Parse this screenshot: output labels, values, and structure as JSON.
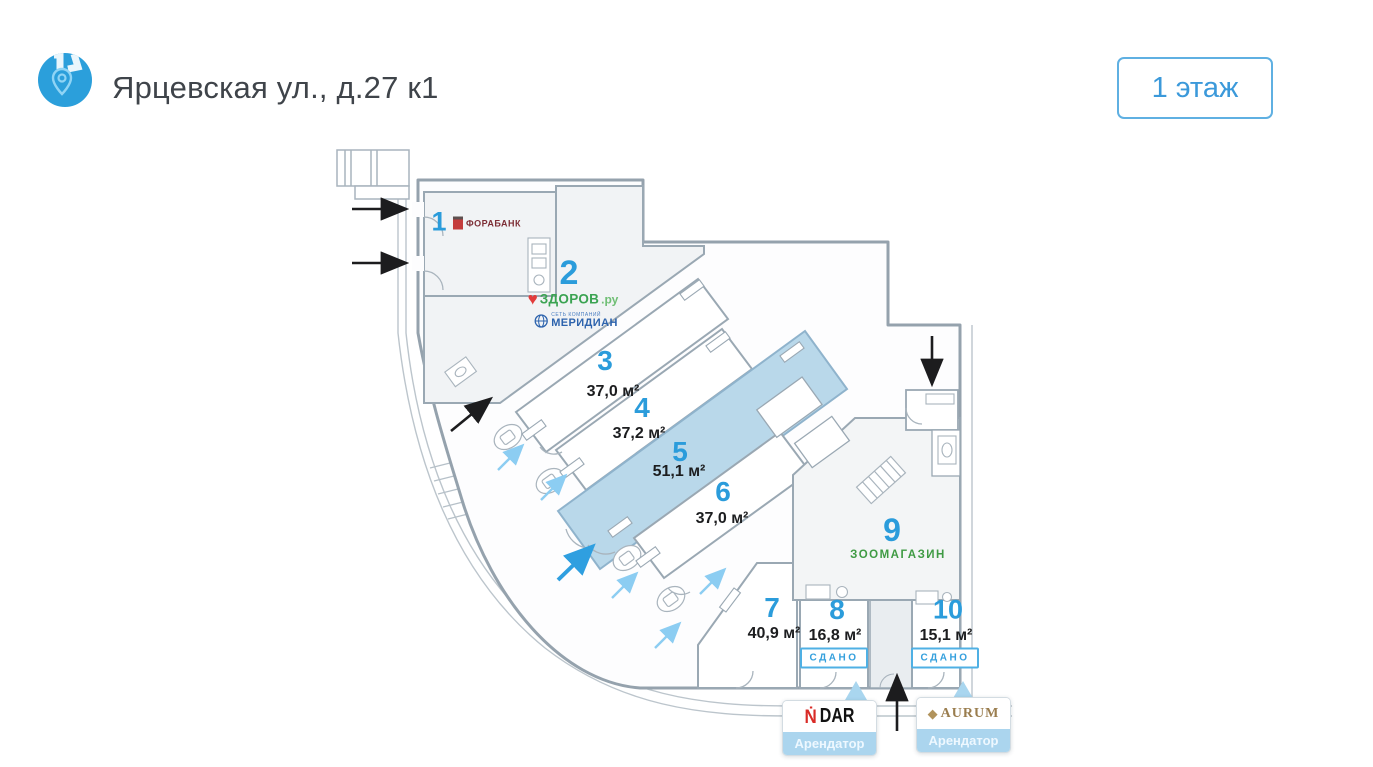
{
  "header": {
    "title": "Ярцевская ул., д.27 к1",
    "floor_button_label": "1 этаж"
  },
  "units": [
    {
      "number": "1",
      "tenant": "ФОРАБАНК"
    },
    {
      "number": "2",
      "tenant_logos": {
        "zdorov_main": "ЗДОРОВ",
        "zdorov_suffix": ".ру",
        "meridian_small": "СЕТЬ КОМПАНИЙ",
        "meridian": "МЕРИДИАН"
      }
    },
    {
      "number": "3",
      "area": "37,0 м²"
    },
    {
      "number": "4",
      "area": "37,2 м²"
    },
    {
      "number": "5",
      "area": "51,1 м²",
      "highlighted": true
    },
    {
      "number": "6",
      "area": "37,0 м²"
    },
    {
      "number": "7",
      "area": "40,9 м²"
    },
    {
      "number": "8",
      "area": "16,8 м²",
      "status": "СДАНО"
    },
    {
      "number": "9",
      "tenant": "ЗООМАГАЗИН"
    },
    {
      "number": "10",
      "area": "15,1 м²",
      "status": "СДАНО"
    }
  ],
  "callouts": [
    {
      "brand_mark": "Ṅ",
      "brand": "DAR",
      "label": "Арендатор"
    },
    {
      "brand_mark": "◆",
      "brand": "AURUM",
      "label": "Арендатор"
    }
  ],
  "colors": {
    "accent_blue": "#2b9cdb",
    "highlight_fill": "#b9d8ea",
    "status_blue": "#35a0dd",
    "zoo_green": "#3f9b44",
    "zdorov_green": "#3ba352",
    "meridian_blue": "#2d63ad",
    "forabank_red": "#c43c3c",
    "dar_red": "#d92b27",
    "aurum_gold": "#9a7d4e",
    "wall_gray": "#9aa8b3"
  }
}
